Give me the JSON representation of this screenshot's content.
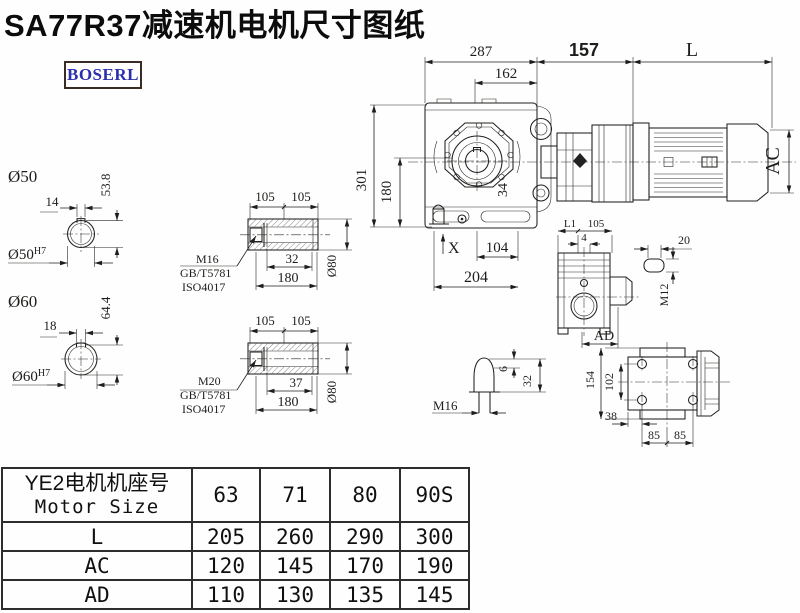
{
  "page": {
    "title": "SA77R37减速机电机尺寸图纸",
    "brand": "BOSERL"
  },
  "colors": {
    "line": "#20201e",
    "logo_text": "#2b2fae",
    "logo_border": "#3a2b24",
    "accent_red": "#cc0000"
  },
  "dims": {
    "top_287": "287",
    "top_162": "162",
    "adapter_len": "157",
    "motor_len": "L",
    "height_total": "301",
    "height_shaft": "180",
    "motor_dia": "AC",
    "bolt_offset": "34",
    "foot_x": "X",
    "foot_104": "104",
    "base_204": "204"
  },
  "shaft50": {
    "dia": "Ø50",
    "key": "14",
    "depth": "53.8",
    "fit": "Ø50",
    "fit_sup": "H7"
  },
  "shaft60": {
    "dia": "Ø60",
    "key": "18",
    "depth": "64.4",
    "fit": "Ø60",
    "fit_sup": "H7"
  },
  "section1": {
    "len_a": "105",
    "len_b": "105",
    "bolt_len": "32",
    "total": "180",
    "dia": "Ø80",
    "thread": "M16",
    "std1": "GB/T5781",
    "std2": "ISO4017"
  },
  "section2": {
    "len_a": "105",
    "len_b": "105",
    "bolt_len": "37",
    "total": "180",
    "dia": "Ø80",
    "thread": "M20",
    "std1": "GB/T5781",
    "std2": "ISO4017"
  },
  "side_view": {
    "l1": "L1",
    "width": "105",
    "offset": "4",
    "ad": "AD"
  },
  "key_detail": {
    "length": "20",
    "thread": "M12"
  },
  "plug_detail": {
    "thread": "M16",
    "tip": "6",
    "length": "32"
  },
  "flange_view": {
    "height": "154",
    "bolt_span": "102",
    "offset": "38",
    "pitch1": "85",
    "pitch2": "85"
  },
  "table": {
    "header_cn": "YE2电机机座号",
    "header_en": "Motor Size",
    "columns": [
      "63",
      "71",
      "80",
      "90S"
    ],
    "rows": [
      {
        "label": "L",
        "values": [
          "205",
          "260",
          "290",
          "300"
        ]
      },
      {
        "label": "AC",
        "values": [
          "120",
          "145",
          "170",
          "190"
        ]
      },
      {
        "label": "AD",
        "values": [
          "110",
          "130",
          "135",
          "145"
        ]
      }
    ]
  }
}
